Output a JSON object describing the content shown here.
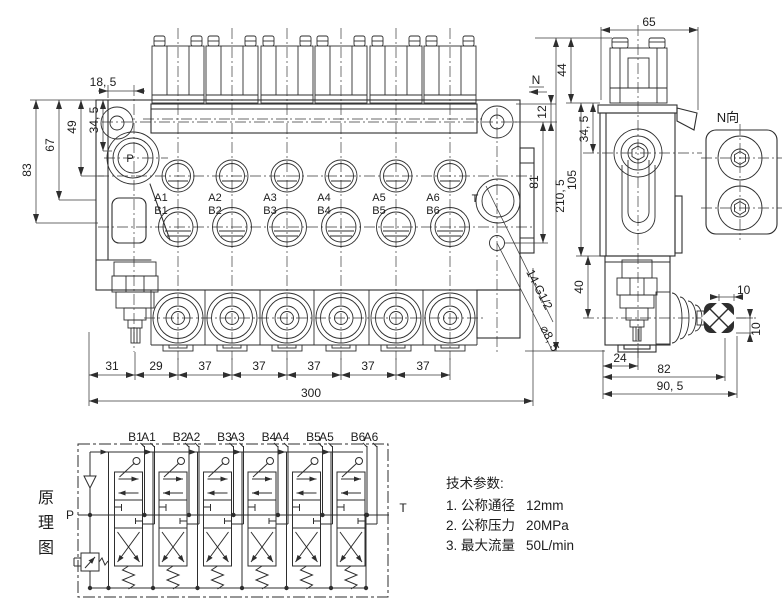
{
  "front_view": {
    "view_arrow_label": "N",
    "ports": {
      "p": "P",
      "t": "T",
      "a": [
        "A1",
        "A2",
        "A3",
        "A4",
        "A5",
        "A6"
      ],
      "b": [
        "B1",
        "B2",
        "B3",
        "B4",
        "B5",
        "B6"
      ]
    },
    "dims": {
      "offset_18_5": "18, 5",
      "height_34_5": "34, 5",
      "height_49": "49",
      "height_67": "67",
      "height_83": "83",
      "right_12": "12",
      "right_81": "81",
      "total_height_210_5": "210, 5",
      "pitch_31": "31",
      "pitch_29": "29",
      "pitch_37": "37",
      "total_width_300": "300"
    },
    "callouts": {
      "thread_ports": "14-G1/2",
      "hole_dia": "⌀8, 5"
    }
  },
  "side_view": {
    "dims": {
      "width_65": "65",
      "height_44": "44",
      "height_34_5": "34, 5",
      "height_105": "105",
      "height_40": "40",
      "width_24": "24",
      "width_82": "82",
      "width_90_5": "90, 5",
      "knob_10_h": "10",
      "knob_10_v": "10"
    }
  },
  "n_view": {
    "label": "N向"
  },
  "schematic": {
    "title_chars": [
      "原",
      "理",
      "图"
    ],
    "inlet": "P",
    "outlet": "T",
    "port_pairs": [
      [
        "B1",
        "A1"
      ],
      [
        "B2",
        "A2"
      ],
      [
        "B3",
        "A3"
      ],
      [
        "B4",
        "A4"
      ],
      [
        "B5",
        "A5"
      ],
      [
        "B6",
        "A6"
      ]
    ]
  },
  "tech_params": {
    "title": "技术参数:",
    "items": [
      {
        "label": "1. 公称通径",
        "value": "12mm"
      },
      {
        "label": "2. 公称压力",
        "value": "20MPa"
      },
      {
        "label": "3. 最大流量",
        "value": "50L/min"
      }
    ]
  }
}
